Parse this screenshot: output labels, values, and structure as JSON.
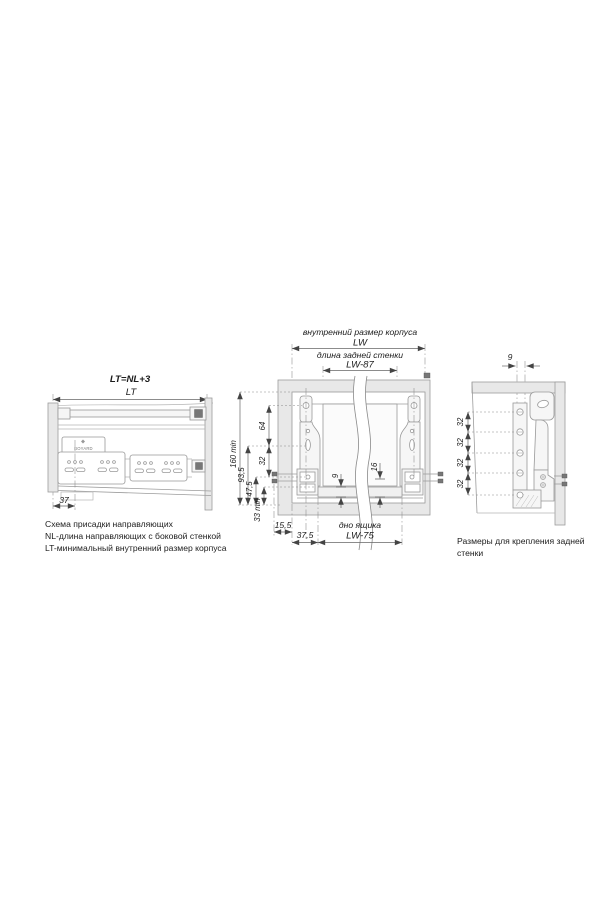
{
  "window": {
    "background": "#ffffff"
  },
  "left_diagram": {
    "formula_label": "LT=NL+3",
    "lt_label": "LT",
    "dim_37": "37",
    "logo_text": "BOYARD",
    "caption": {
      "line1": "Схема присадки направляющих",
      "line2": "NL-длина направляющих с боковой стенкой",
      "line3": "LT-минимальный внутренний размер корпуса"
    }
  },
  "middle_diagram": {
    "inner_size_label": "внутренний размер корпуса",
    "lw_label": "LW",
    "back_wall_label": "длина задней стенки",
    "lw87_label": "LW-87",
    "dim_160_min": "160 min",
    "dim_64": "64",
    "dim_32": "32",
    "dim_93_5": "93,5",
    "dim_47_5": "47,5",
    "dim_33_min": "33 min",
    "dim_15_5": "15,5",
    "dim_37_5": "37,5",
    "dim_9": "9",
    "dim_16": "16",
    "drawer_bottom_label": "дно ящика",
    "lw75_label": "LW-75"
  },
  "right_diagram": {
    "dim_9": "9",
    "dim_32_labels": [
      "32",
      "32",
      "32",
      "32"
    ],
    "caption": {
      "line1": "Размеры для крепления задней",
      "line2": "стенки"
    }
  },
  "colors": {
    "drawing_line": "#9c9c9c",
    "dimension_line": "#666666",
    "text": "#1c1c1c",
    "wall_fill": "#e8e8e8"
  }
}
